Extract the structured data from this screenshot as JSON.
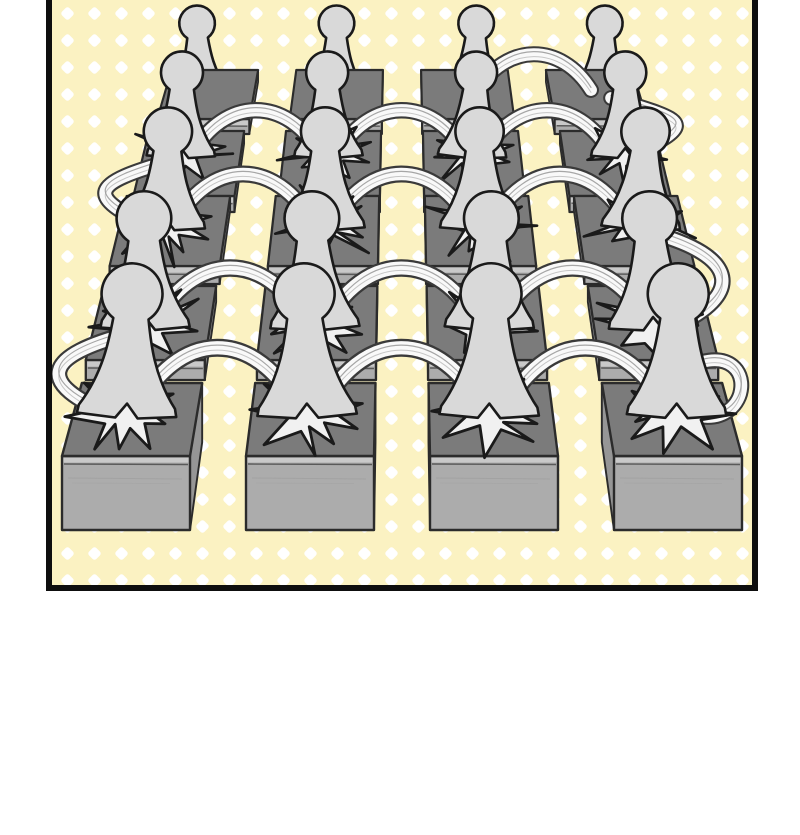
{
  "meta": {
    "type": "comic-panel-illustration",
    "description": "Comic panel (top edge cropped) on a white page: a 5x4 perspective grid of gray pedestal blocks on a pale-yellow polka-dot background. A faceless gray pawn-like figure seen from behind stands on every block. A white serpentine motion ribbon bounces from figure to figure with star-shaped impact splashes at landing points; the path snakes right-to-left down the rows and ends in a small loop at the front-right block. No text appears anywhere in the image."
  },
  "page": {
    "width": 800,
    "height": 835,
    "background": "#FFFFFF"
  },
  "panel": {
    "frame": {
      "left": 46,
      "right": 752,
      "bottom": 585,
      "thickness": 6,
      "top_border_visible": false
    },
    "background": {
      "dot_spacing": 27,
      "dot_half": 5.2,
      "dot_corner": 2.8
    },
    "colors": {
      "panel_bg": "#FBF2C2",
      "dot": "#FFFFFF",
      "frame": "#0E0E0E",
      "block_top": "#7B7B7B",
      "block_front": "#ACACAC",
      "block_front_strip": "#C9C9C9",
      "block_front_line": "#4B4B4B",
      "block_side": "#969696",
      "outline": "#2B2B2B",
      "figure_fill": "#D9D9D9",
      "figure_outline": "#1A1A1A",
      "splash_fill": "#F1F1F1",
      "arc_fill": "#F9F9F9",
      "arc_outline": "#3A3A3A",
      "sketch": "#9C9C9C"
    },
    "grid": {
      "center_x": 402,
      "col_offsets": [
        -276,
        -92,
        92,
        276
      ],
      "block": {
        "half_width": 64,
        "back_width_scale": 0.94,
        "back_shift": 0.058
      },
      "rows": [
        {
          "f": 0.72,
          "top_back": 70,
          "top_front": 119,
          "face_h": 15,
          "feet_y": 96,
          "fig_h": 90,
          "splash": false
        },
        {
          "f": 0.79,
          "top_back": 131,
          "top_front": 196,
          "face_h": 16,
          "feet_y": 158,
          "fig_h": 106,
          "splash": true
        },
        {
          "f": 0.86,
          "top_back": 196,
          "top_front": 266,
          "face_h": 18,
          "feet_y": 230,
          "fig_h": 122,
          "splash": true
        },
        {
          "f": 0.93,
          "top_back": 286,
          "top_front": 360,
          "face_h": 20,
          "feet_y": 330,
          "fig_h": 138,
          "splash": true
        },
        {
          "f": 1.0,
          "top_back": 383,
          "top_front": 456,
          "face_h": 74,
          "feet_y": 418,
          "fig_h": 154,
          "splash": true
        }
      ]
    },
    "ribbons": {
      "lane_rises": [
        40,
        46,
        54,
        60,
        68
      ],
      "lane_hops": [
        [
          [
            2,
            3
          ]
        ],
        [
          [
            0,
            1
          ],
          [
            1,
            2
          ],
          [
            2,
            3
          ]
        ],
        [
          [
            0,
            1
          ],
          [
            1,
            2
          ],
          [
            2,
            3
          ]
        ],
        [
          [
            0,
            1
          ],
          [
            1,
            2
          ],
          [
            2,
            3
          ]
        ],
        [
          [
            0,
            1
          ],
          [
            1,
            2
          ],
          [
            2,
            3
          ]
        ]
      ],
      "edge_hops": [
        {
          "from_row": 0,
          "to_row": 1,
          "col": 3,
          "side": "right"
        },
        {
          "from_row": 1,
          "to_row": 2,
          "col": 0,
          "side": "left"
        },
        {
          "from_row": 2,
          "to_row": 3,
          "col": 3,
          "side": "right"
        },
        {
          "from_row": 3,
          "to_row": 4,
          "col": 0,
          "side": "left"
        }
      ],
      "terminal_curl": {
        "row": 4,
        "col": 3
      }
    },
    "figure": {
      "count": 20,
      "unit_height": 96,
      "style": "faceless pawn viewed from behind"
    },
    "splash_count": 16
  }
}
